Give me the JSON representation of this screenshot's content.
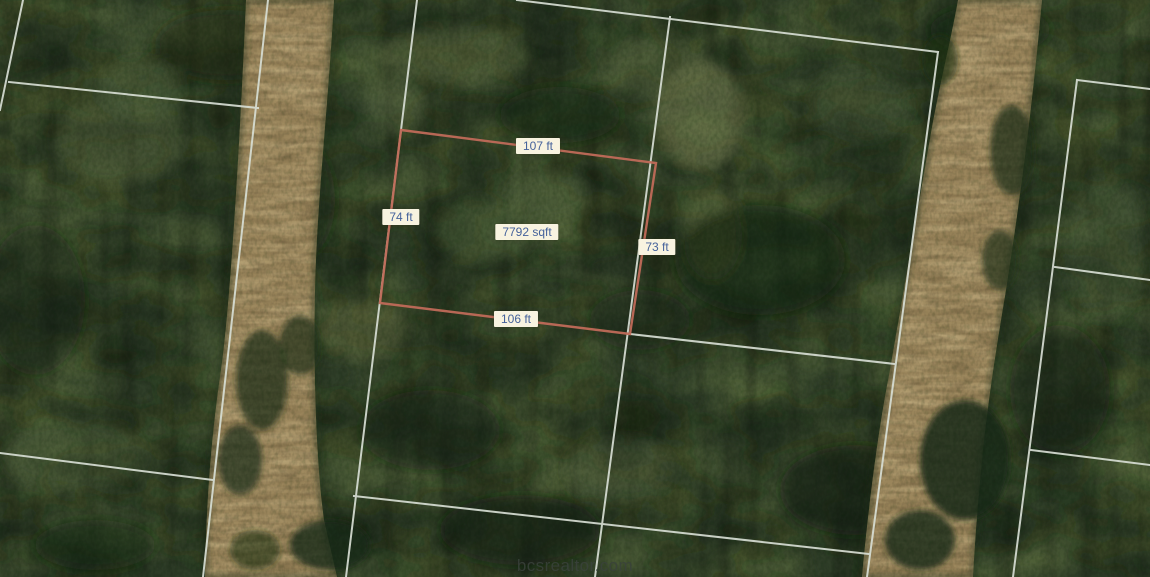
{
  "map": {
    "watermark": "bcsrealtor.com"
  },
  "parcel": {
    "area_label": "7792 sqft",
    "side_labels": {
      "top": "107 ft",
      "left": "74 ft",
      "right": "73 ft",
      "bottom": "106 ft"
    },
    "outline_color": "#c06a59"
  },
  "style": {
    "label_bg": "#f8f3e0",
    "label_text": "#45629b",
    "boundary_line_color": "#d7ded4",
    "road_color": "#9a855b",
    "forest_color": "#2f3e28"
  }
}
